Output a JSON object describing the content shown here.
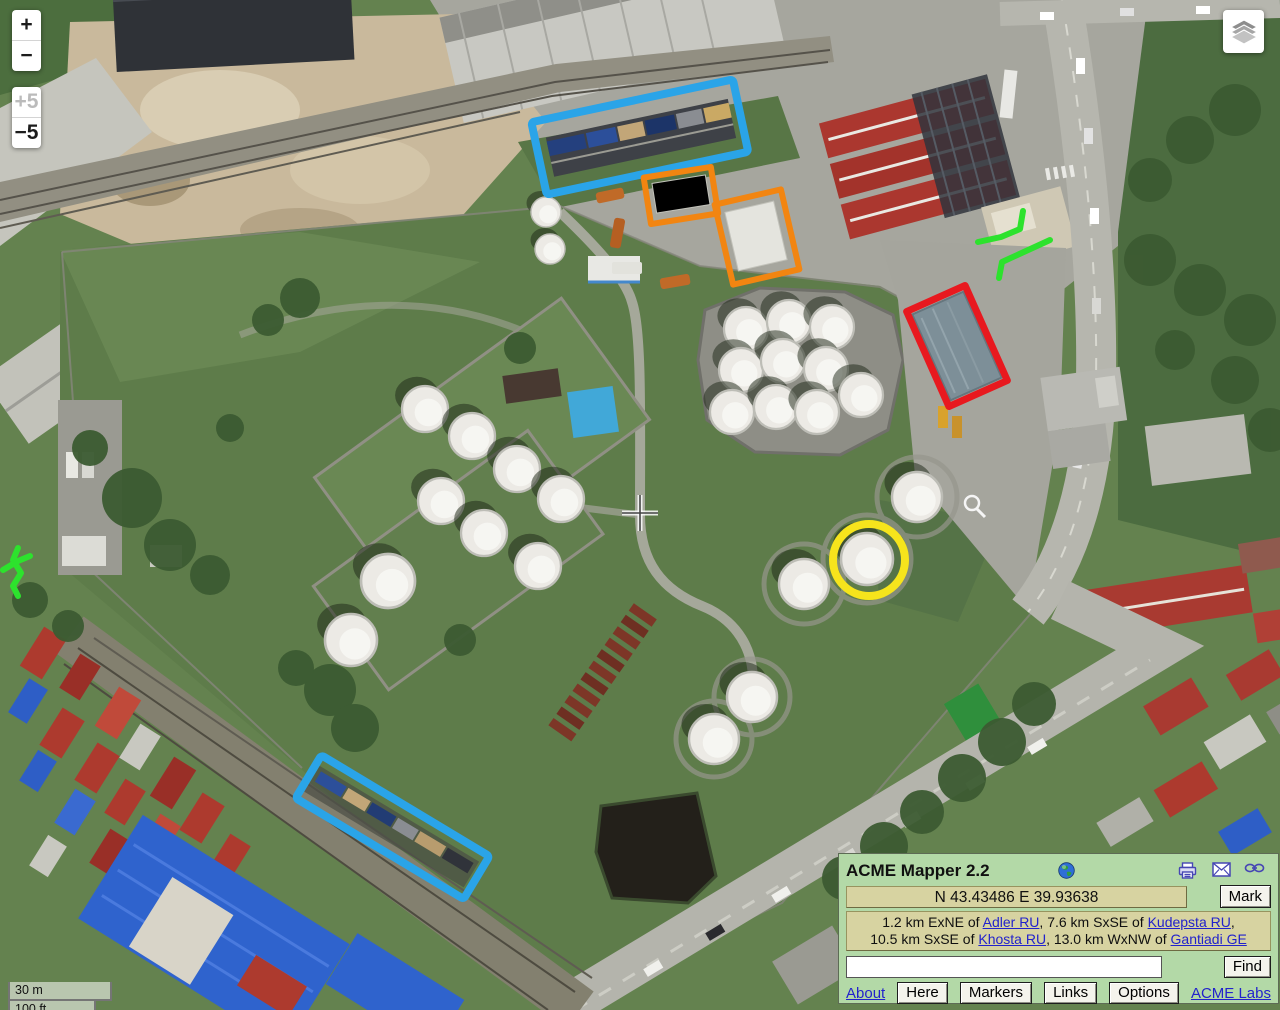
{
  "map": {
    "annotation_colors": {
      "blue": "#2aa4e8",
      "orange": "#f28511",
      "red": "#e8191f",
      "yellow": "#f6e41c",
      "green": "#2de22d"
    },
    "icons": [
      "layers-icon",
      "crosshair-icon",
      "magnifier-icon"
    ]
  },
  "controls": {
    "zoom_in": "+",
    "zoom_out": "−",
    "zoom_in_5": "+5",
    "zoom_out_5": "−5",
    "scale_metric": "30 m",
    "scale_imperial": "100 ft"
  },
  "panel": {
    "title": "ACME Mapper 2.2",
    "coordinates": "N 43.43486 E 39.93638",
    "mark_label": "Mark",
    "find_label": "Find",
    "search_value": "",
    "icons": [
      "globe-icon",
      "print-icon",
      "email-icon",
      "link-icon"
    ],
    "location": {
      "pre1": "1.2 km ExNE of ",
      "link1": "Adler RU",
      "mid1": ", 7.6 km SxSE of ",
      "link2": "Kudepsta RU",
      "end1": ",",
      "pre2": "10.5 km SxSE of ",
      "link3": "Khosta RU",
      "mid2": ", 13.0 km WxNW of ",
      "link4": "Gantiadi GE"
    },
    "links": {
      "about": "About",
      "acme_labs": "ACME Labs"
    },
    "buttons": {
      "here": "Here",
      "markers": "Markers",
      "links": "Links",
      "options": "Options"
    }
  }
}
